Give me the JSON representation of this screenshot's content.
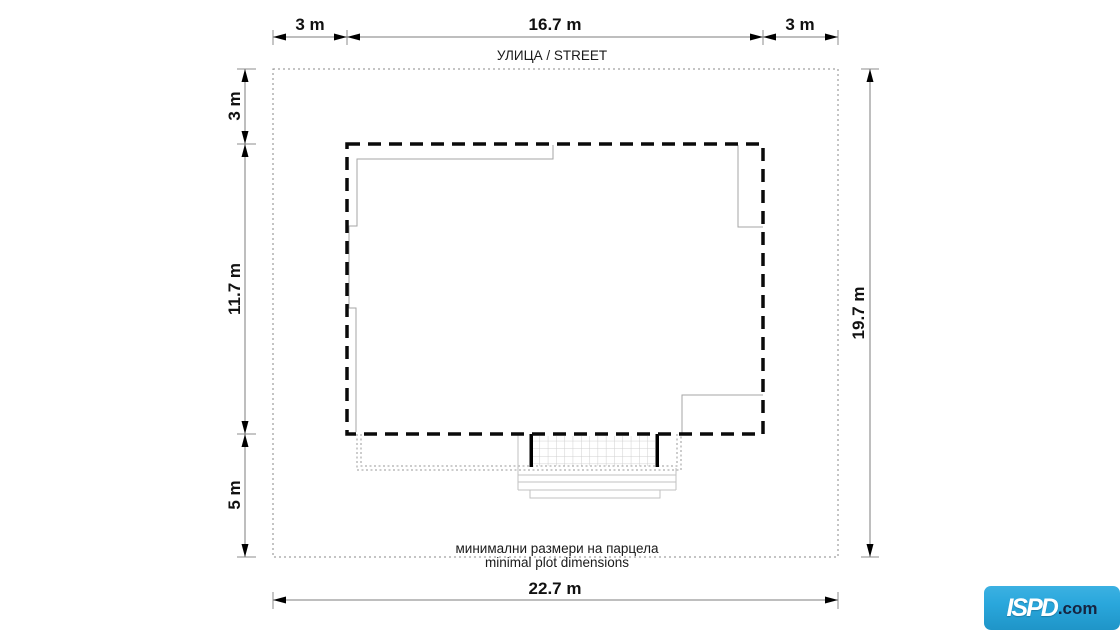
{
  "street_label": "УЛИЦА / STREET",
  "captions": {
    "bg": "минимални размери на парцела",
    "en": "minimal plot dimensions"
  },
  "dimensions": {
    "top_left": "3 m",
    "top_center": "16.7 m",
    "top_right": "3 m",
    "left_top": "3 m",
    "left_middle": "11.7 m",
    "left_bottom": "5 m",
    "right_side": "19.7 m",
    "bottom": "22.7 m"
  },
  "logo": {
    "brand": "ISPD",
    "suffix": ".com",
    "bg_color": "#2aa7dc",
    "brand_color": "#ffffff",
    "suffix_color": "#162440"
  },
  "colors": {
    "ink": "#000000",
    "plot_boundary": "#8a8a8a",
    "footprint": "#a6a6a6",
    "grid": "#cfcfcf"
  }
}
